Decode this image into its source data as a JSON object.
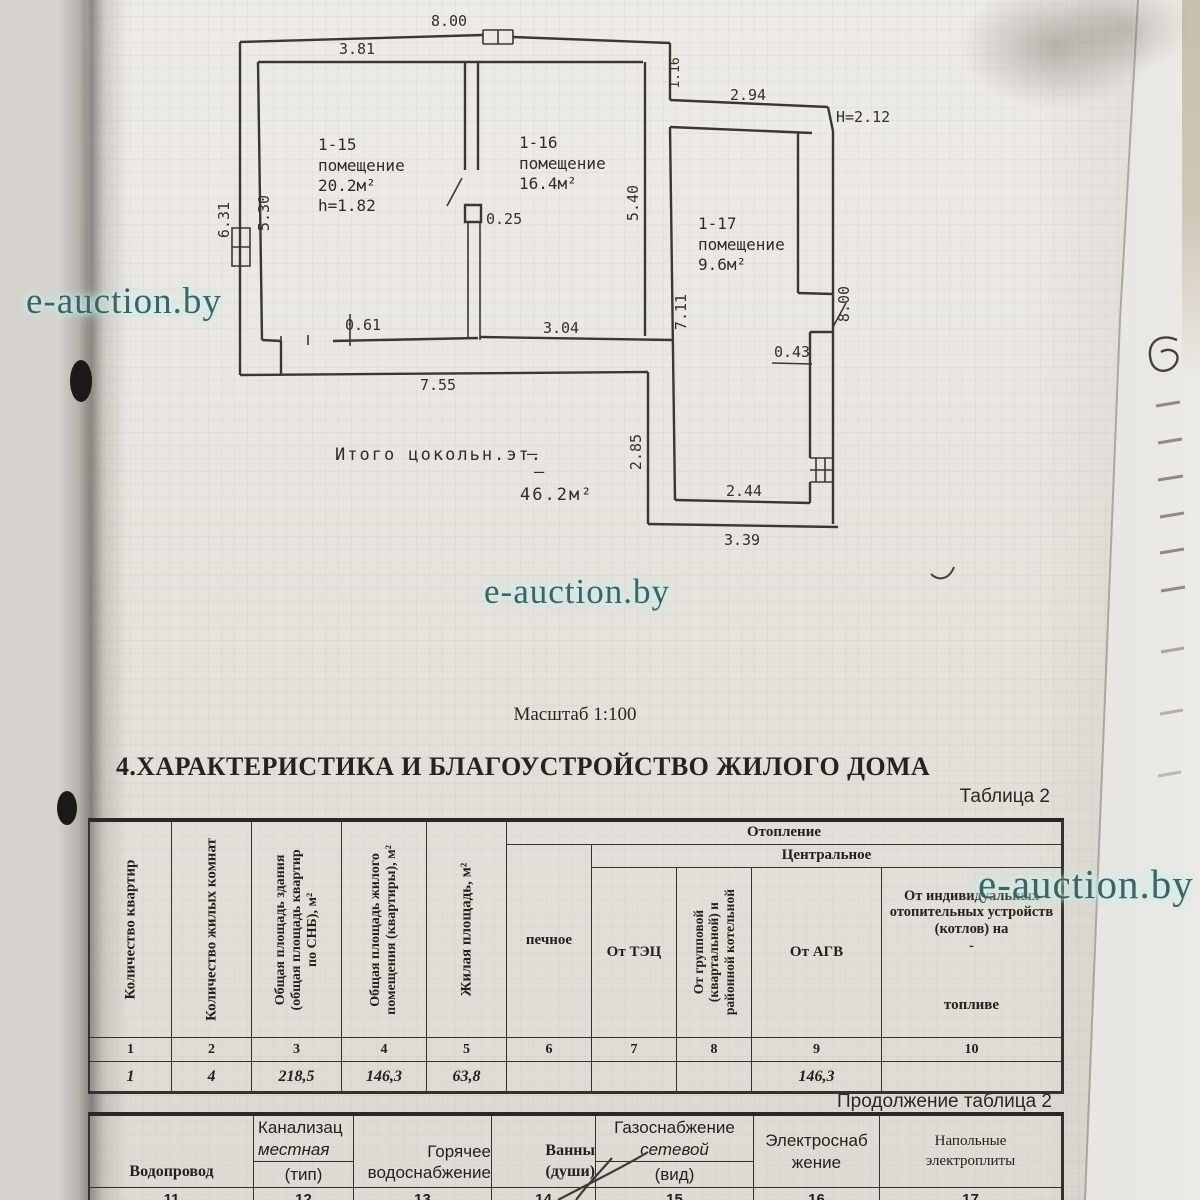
{
  "watermark": {
    "text": "e-auction.by"
  },
  "plan": {
    "scale_label": "Масштаб 1:100",
    "rooms": [
      {
        "id": "1-15",
        "label": "помещение",
        "area": "20.2м²",
        "note": "h=1.82"
      },
      {
        "id": "1-16",
        "label": "помещение",
        "area": "16.4м²"
      },
      {
        "id": "1-17",
        "label": "помещение",
        "area": "9.6м²"
      }
    ],
    "total": {
      "label": "Итого цокольн.эт.",
      "dash": "–",
      "value": "46.2м²"
    },
    "dims": {
      "top_width": "8.00",
      "room15_top": "3.81",
      "notch": "1.16",
      "upper_right": "2.94",
      "height_mark": "H=2.12",
      "left_outer": "6.31",
      "left_inner": "5.30",
      "room16_right": "5.40",
      "stub": "0.25",
      "door": "0.61",
      "room16_bottom": "3.04",
      "bottom_left": "7.55",
      "corridor_right": "7.11",
      "right_wall": "8.00",
      "shaft": "0.43",
      "corridor_inner": "2.44",
      "corridor_left": "2.85",
      "corridor_outer": "3.39"
    }
  },
  "section": {
    "heading": "4.ХАРАКТЕРИСТИКА И БЛАГОУСТРОЙСТВО ЖИЛОГО ДОМА",
    "table_label": "Таблица 2",
    "continuation_label": "Продолжение таблица 2"
  },
  "table1": {
    "heating": "Отопление",
    "central": "Центральное",
    "col1": {
      "num": "1",
      "header": "Количество квартир",
      "value": "1"
    },
    "col2": {
      "num": "2",
      "header": "Количество жилых комнат",
      "value": "4"
    },
    "col3": {
      "num": "3",
      "header": "Общая площадь здания (общая площадь квартир по СНБ), м²",
      "value": "218,5"
    },
    "col4": {
      "num": "4",
      "header": "Общая площадь жилого помещения (квартиры), м²",
      "value": "146,3"
    },
    "col5": {
      "num": "5",
      "header": "Жилая площадь, м²",
      "value": "63,8"
    },
    "col6": {
      "num": "6",
      "header": "печное",
      "value": ""
    },
    "col7": {
      "num": "7",
      "header": "От ТЭЦ",
      "value": ""
    },
    "col8": {
      "num": "8",
      "header": "От групповой (квартальной) и районной котельной",
      "value": ""
    },
    "col9": {
      "num": "9",
      "header": "От АГВ",
      "value": "146,3"
    },
    "col10": {
      "num": "10",
      "header": "От индивидуальных отопительных устройств (котлов) на",
      "dash": "-",
      "subheader": "топливе",
      "value": ""
    }
  },
  "table2": {
    "col11": {
      "num": "11",
      "line1": "Водопровод"
    },
    "col12": {
      "num": "12",
      "line1": "Канализац",
      "line2": "местная",
      "sub": "(тип)"
    },
    "col13": {
      "num": "13",
      "line1": "Горячее",
      "line2": "водоснабжение"
    },
    "col14": {
      "num": "14",
      "line1": "Ванны",
      "line2": "(души)"
    },
    "col15": {
      "num": "15",
      "line1": "Газоснабжение",
      "line2": "сетевой",
      "sub": "(вид)"
    },
    "col16": {
      "num": "16",
      "line1": "Электроснаб",
      "line2": "жение"
    },
    "col17": {
      "num": "17",
      "line1": "Напольные",
      "line2": "электроплиты"
    }
  }
}
